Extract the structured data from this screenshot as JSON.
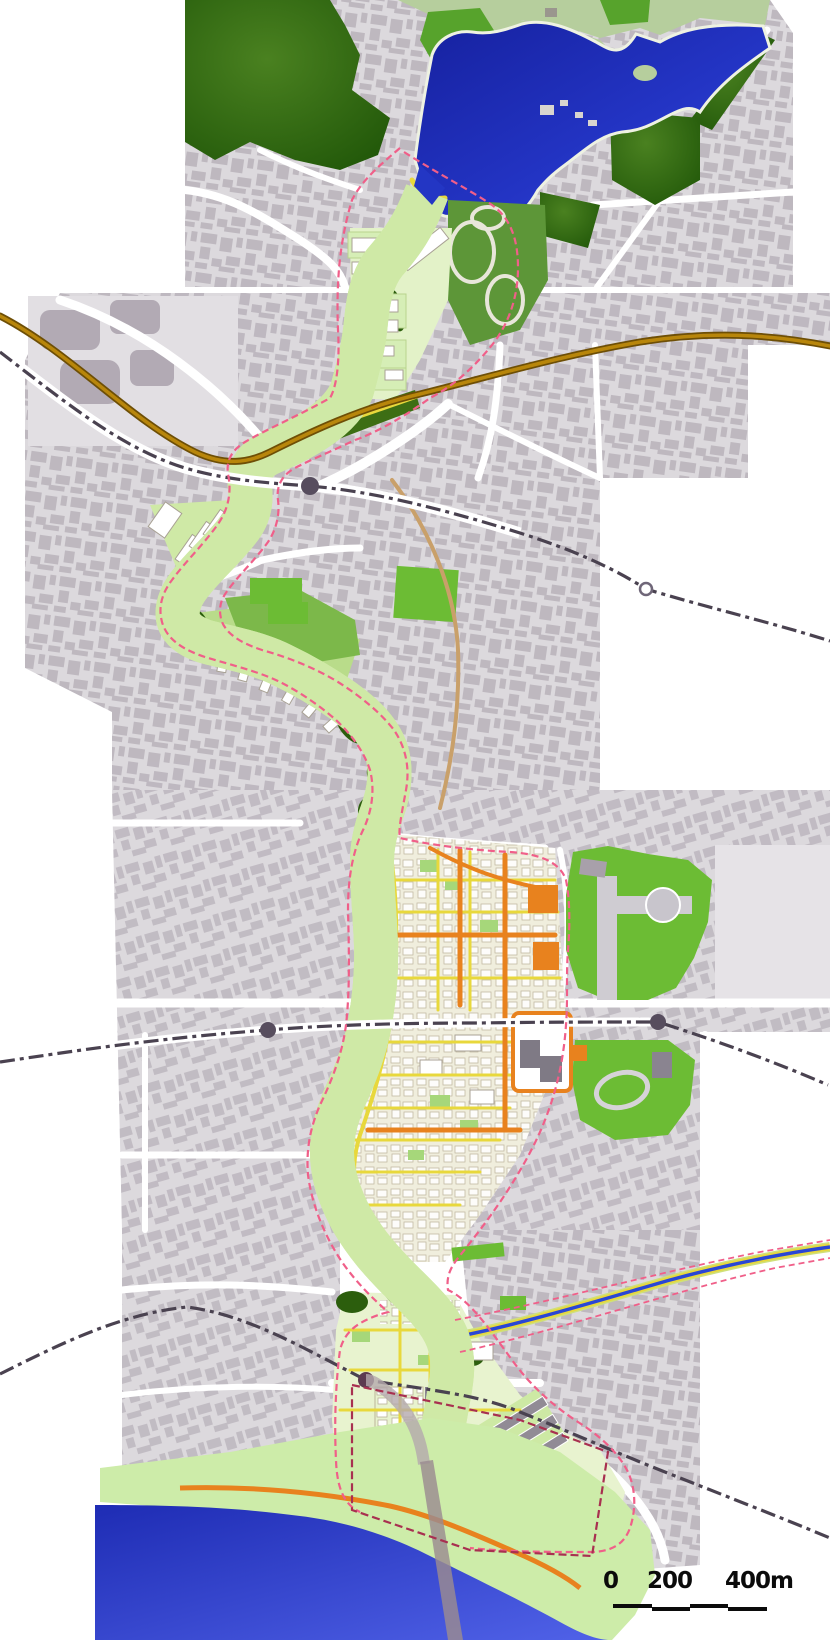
{
  "map": {
    "description": "urban riverside masterplan map",
    "scale_bar": {
      "labels": [
        "0",
        "200",
        "400m"
      ],
      "bar_color": "#0b0b0b"
    },
    "palette": {
      "background": "#ffffff",
      "urban_fabric": "#dcd9dd",
      "urban_buildings": "#a49ca6",
      "forest_green": "#25610b",
      "park_green": "#6cbc34",
      "olive_park": "#5d9638",
      "light_green_band": "#cfe9a6",
      "riverside_strip": "#cdeca9",
      "lake_blue": "#1f2fc0",
      "river_blue": "#2946d6",
      "arterial_brown": "#b8860b",
      "railway_gray": "#4a4250",
      "commercial_orange": "#e8821e",
      "pedestrian_yellow": "#e8d83c",
      "boundary_pink": "#f05f89",
      "boundary_crimson": "#a83050"
    },
    "markers": {
      "filled_station_count": 4,
      "open_station_count": 1
    }
  }
}
